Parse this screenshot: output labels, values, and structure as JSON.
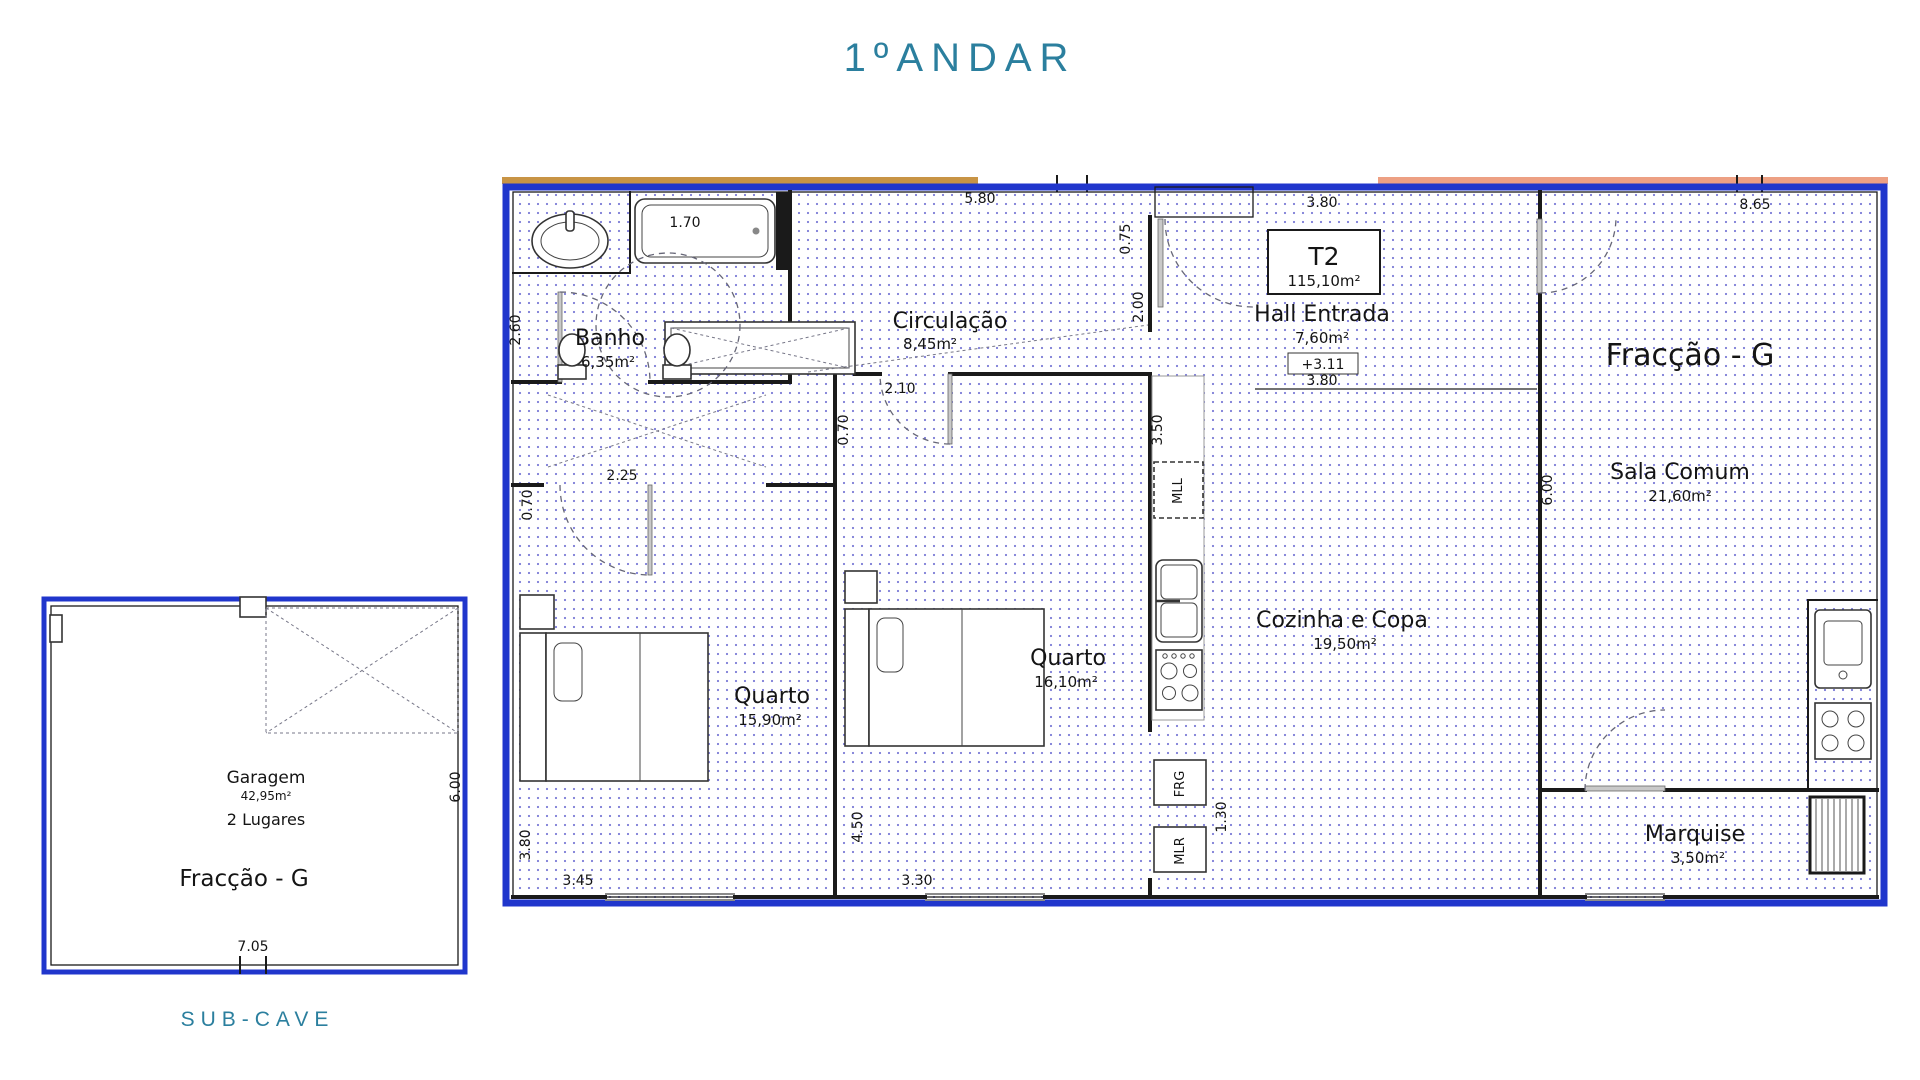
{
  "title": "1ºANDAR",
  "sub_cave": {
    "caption": "SUB-CAVE",
    "garage_name": "Garagem",
    "garage_area": "42,95m²",
    "garage_spaces": "2 Lugares",
    "fraction": "Fracção - G",
    "dim_width": "7.05",
    "dim_height": "6.00"
  },
  "floor_plan": {
    "fraction": "Fracção - G",
    "unit_type": "T2",
    "unit_area": "115,10m²",
    "level_mark": "+3.11",
    "rooms": {
      "banho": {
        "name": "Banho",
        "area": "6,35m²"
      },
      "circulacao": {
        "name": "Circulação",
        "area": "8,45m²"
      },
      "hall": {
        "name": "Hall Entrada",
        "area": "7,60m²"
      },
      "sala": {
        "name": "Sala Comum",
        "area": "21,60m²"
      },
      "quarto1": {
        "name": "Quarto",
        "area": "15,90m²"
      },
      "quarto2": {
        "name": "Quarto",
        "area": "16,10m²"
      },
      "cozinha": {
        "name": "Cozinha e Copa",
        "area": "19,50m²"
      },
      "marquise": {
        "name": "Marquise",
        "area": "3,50m²"
      }
    },
    "appliances": {
      "dishwasher": "MLL",
      "fridge": "FRG",
      "washer": "MLR"
    },
    "dims": {
      "tub": "1.70",
      "top_left": "5.80",
      "top_hall": "3.80",
      "top_right": "8.65",
      "banho_height": "2.60",
      "vest_width": "2.25",
      "vest_left": "0.70",
      "wardrobe": "2.10",
      "wardrobe_depth": "0.70",
      "entry_a": "0.75",
      "entry_b": "2.00",
      "hall_width": "3.80",
      "kitchen_top": "3.50",
      "sala_wall": "6.00",
      "quarto2_side": "4.50",
      "left_bottom": "3.80",
      "bottom_q1": "3.45",
      "bottom_q2": "3.30",
      "nook": "1.30"
    }
  },
  "colors": {
    "heading_teal": "#2b7f9e",
    "wall_blue": "#2036cc",
    "band_orange": "#c89445",
    "band_salmon": "#eda083",
    "floor_dot": "#7b7bd6"
  }
}
